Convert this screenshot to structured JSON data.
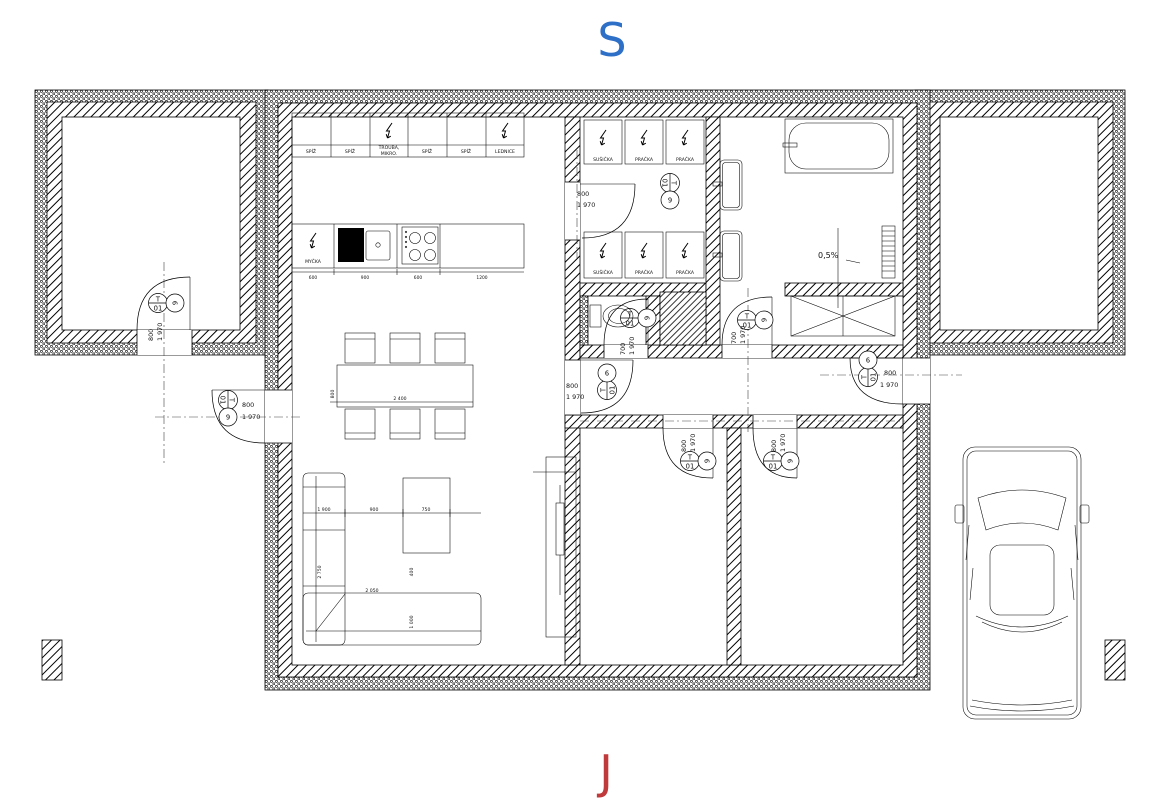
{
  "compass": {
    "north": "S",
    "south": "J",
    "north_color": "#2e6fc8",
    "south_color": "#c0393b"
  },
  "kitchen": {
    "upper_cabinets": [
      {
        "label": "SPÍŽ",
        "label2": ""
      },
      {
        "label": "SPÍŽ",
        "label2": ""
      },
      {
        "label": "TROUBA,",
        "label2": "MIKRO."
      },
      {
        "label": "SPÍŽ",
        "label2": ""
      },
      {
        "label": "SPÍŽ",
        "label2": ""
      },
      {
        "label": "LEDNICE",
        "label2": ""
      }
    ],
    "dishwasher_label": "MYČKA",
    "counter_dims": [
      "600",
      "900",
      "600",
      "1200"
    ]
  },
  "laundry": {
    "top_row": [
      {
        "label": "SUŠIČKA"
      },
      {
        "label": "PRAČKA"
      },
      {
        "label": "PRAČKA"
      }
    ],
    "bottom_row": [
      {
        "label": "SUŠIČKA"
      },
      {
        "label": "PRAČKA"
      },
      {
        "label": "PRAČKA"
      }
    ]
  },
  "bathroom": {
    "slope_label": "0,5%"
  },
  "dining": {
    "length": "2 400",
    "depth": "800"
  },
  "sofa": {
    "dim_top_1": "1 900",
    "dim_top_2": "900",
    "dim_top_3": "750",
    "dim_left": "2 750",
    "dim_bottom": "2 050",
    "dim_right": "1 000",
    "dim_gap": "400"
  },
  "door_tag": {
    "letter": "T",
    "number": "01",
    "aux": "9"
  },
  "doors": {
    "storage": {
      "w": "800",
      "h": "1 970"
    },
    "west_entry": {
      "w": "800",
      "h": "1 970"
    },
    "laundry": {
      "w": "800",
      "h": "1 970"
    },
    "wc": {
      "w": "700",
      "h": "1 970"
    },
    "bathroom": {
      "w": "700",
      "h": "1 970"
    },
    "hall": {
      "w": "800",
      "h": "1 970"
    },
    "east_entry": {
      "w": "800",
      "h": "1 970"
    },
    "bedroom1": {
      "w": "800",
      "h": "1 970"
    },
    "bedroom2": {
      "w": "800",
      "h": "1 970"
    }
  }
}
